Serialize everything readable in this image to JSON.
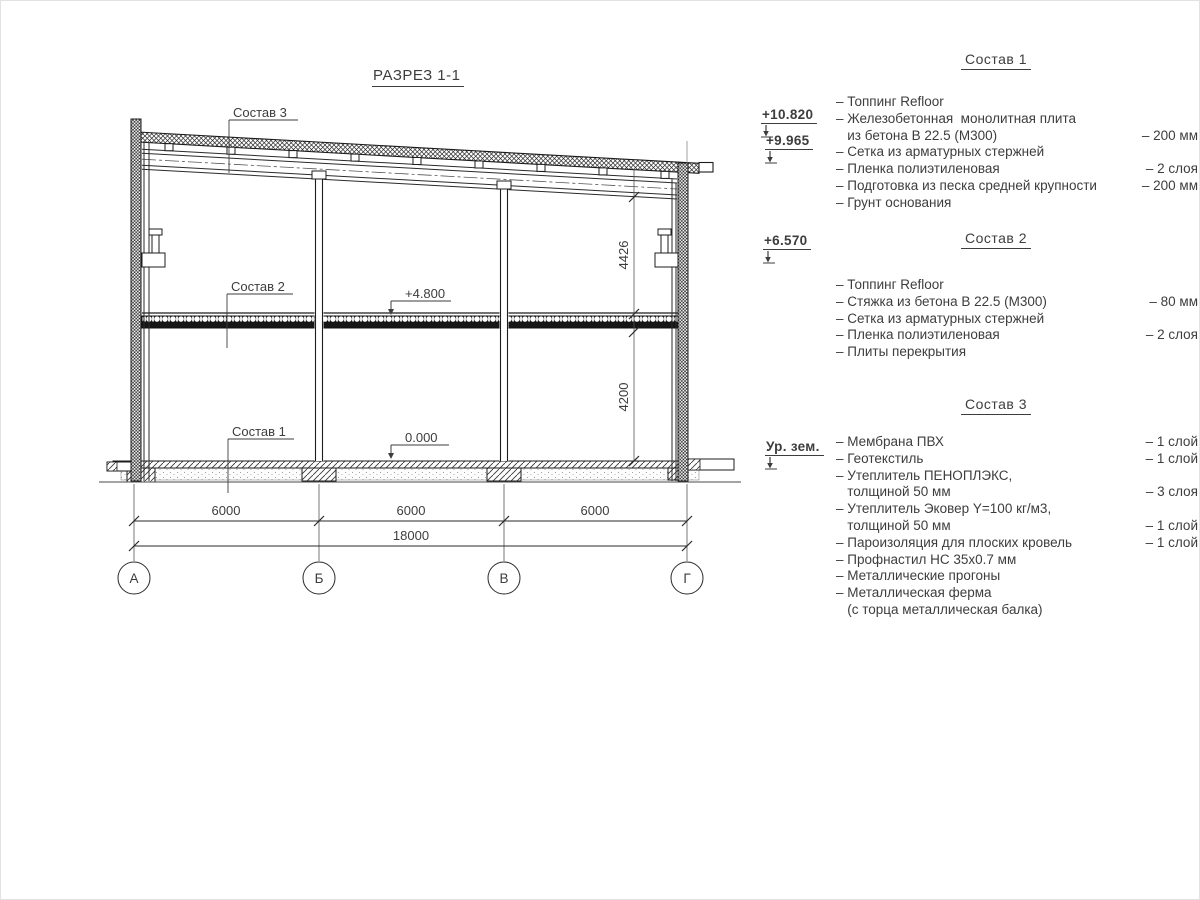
{
  "page": {
    "title": "РАЗРЕЗ 1-1"
  },
  "colors": {
    "line": "#1c1c1c",
    "text": "#3d3d3d"
  },
  "drawing": {
    "leaders": {
      "s1": "Состав 1",
      "s2": "Состав 2",
      "s3": "Состав 3"
    },
    "levels": {
      "mid": "+4.800",
      "zero": "0.000"
    },
    "dims": {
      "bay1": "6000",
      "bay2": "6000",
      "bay3": "6000",
      "total": "18000",
      "upper_height": "4426",
      "lower_height": "4200"
    },
    "grid_axes": [
      "А",
      "Б",
      "В",
      "Г"
    ]
  },
  "elevations": {
    "roof_top": "+10.820",
    "roof_low": "+9.965",
    "corbel": "+6.570",
    "ground": "Ур. зем."
  },
  "compositions": [
    {
      "title": "Состав 1",
      "items": [
        {
          "text": "– Топпинг Refloor",
          "value": ""
        },
        {
          "text": "– Железобетонная  монолитная плита\n   из бетона В 22.5 (М300)",
          "value": "– 200 мм"
        },
        {
          "text": "– Сетка из арматурных стержней",
          "value": ""
        },
        {
          "text": "– Пленка полиэтиленовая",
          "value": "–  2 слоя"
        },
        {
          "text": "– Подготовка из песка средней крупности",
          "value": "– 200 мм"
        },
        {
          "text": "– Грунт основания",
          "value": ""
        }
      ]
    },
    {
      "title": "Состав 2",
      "items": [
        {
          "text": "– Топпинг Refloor",
          "value": ""
        },
        {
          "text": "– Стяжка из бетона В 22.5 (М300)",
          "value": "– 80 мм"
        },
        {
          "text": "– Сетка из арматурных стержней",
          "value": ""
        },
        {
          "text": "– Пленка полиэтиленовая",
          "value": "–  2 слоя"
        },
        {
          "text": "– Плиты перекрытия",
          "value": ""
        }
      ]
    },
    {
      "title": "Состав 3",
      "items": [
        {
          "text": "– Мембрана ПВХ",
          "value": "– 1 слой"
        },
        {
          "text": "– Геотекстиль",
          "value": "– 1 слой"
        },
        {
          "text": "– Утеплитель ПЕНОПЛЭКС,\n   толщиной 50 мм",
          "value": "– 3 слоя"
        },
        {
          "text": "– Утеплитель Эковер Y=100 кг/м3,\n   толщиной 50 мм",
          "value": "– 1 слой"
        },
        {
          "text": "– Пароизоляция для плоских кровель",
          "value": "– 1 слой"
        },
        {
          "text": "– Профнастил НС 35х0.7 мм",
          "value": ""
        },
        {
          "text": "– Металлические прогоны",
          "value": ""
        },
        {
          "text": "– Металлическая ферма\n   (с торца металлическая балка)",
          "value": ""
        }
      ]
    }
  ]
}
